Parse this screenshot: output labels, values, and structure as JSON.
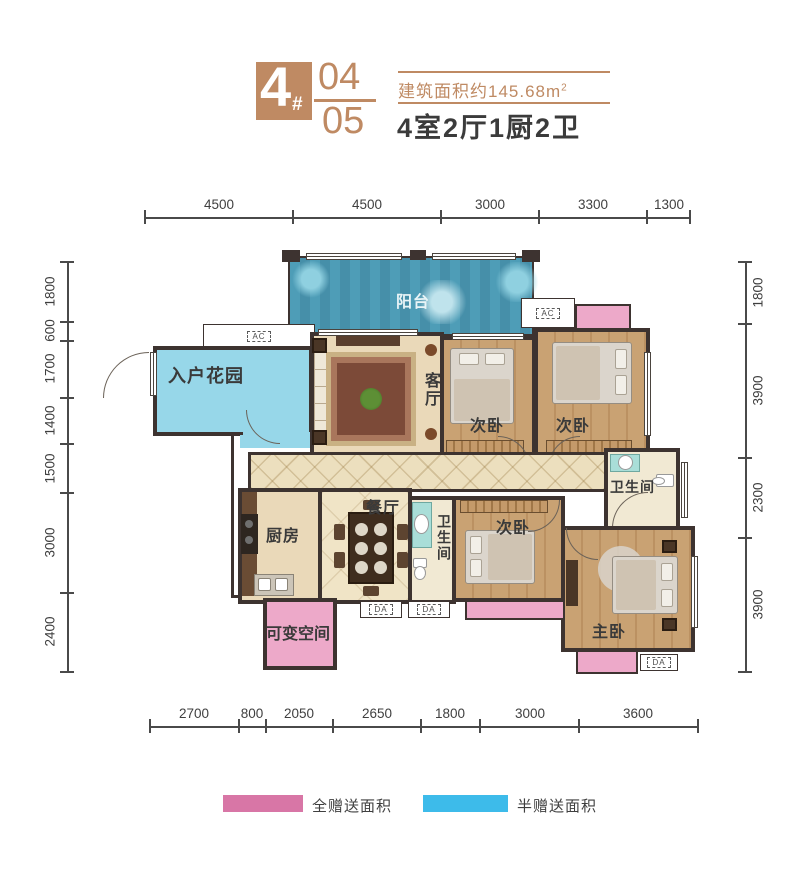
{
  "header": {
    "block_number": "4",
    "block_suffix": "#",
    "unit_top": "04",
    "unit_bottom": "05",
    "area_text": "建筑面积约145.68m",
    "area_superscript": "2",
    "layout_summary": "4室2厅1厨2卫"
  },
  "dimensions": {
    "top": [
      "4500",
      "4500",
      "3000",
      "3300",
      "1300"
    ],
    "bottom": [
      "2700",
      "800",
      "2050",
      "2650",
      "1800",
      "3000",
      "3600"
    ],
    "left": [
      "1800",
      "600",
      "1700",
      "1400",
      "1500",
      "3000",
      "2400"
    ],
    "right": [
      "1800",
      "3900",
      "2300",
      "3900"
    ]
  },
  "rooms": {
    "balcony": "阳台",
    "entry_garden": "入户花园",
    "living_room": "客厅",
    "bedroom_top_left": "次卧",
    "bedroom_top_right": "次卧",
    "bedroom_mid": "次卧",
    "master_bedroom": "主卧",
    "dining_room": "餐厅",
    "kitchen": "厨房",
    "bathroom_right": "卫生间",
    "bathroom_mid": "卫生间",
    "flex_space": "可变空间"
  },
  "equipment": {
    "ac_label": "AC",
    "da_label": "DA"
  },
  "legend": {
    "full_gift": {
      "label": "全赠送面积",
      "color": "#d876a6"
    },
    "half_gift": {
      "label": "半赠送面积",
      "color": "#3dbbea"
    }
  },
  "colors": {
    "accent_tan": "#bf8a63",
    "wall_dark": "#3d3330",
    "balcony_teal": "#4e9db7",
    "garden_blue": "#97d7e9",
    "gift_pink_area": "#eda9c9",
    "wood_floor": "#c9a273",
    "tile_beige": "#ead9b9",
    "text_dark": "#3f3f3f"
  }
}
